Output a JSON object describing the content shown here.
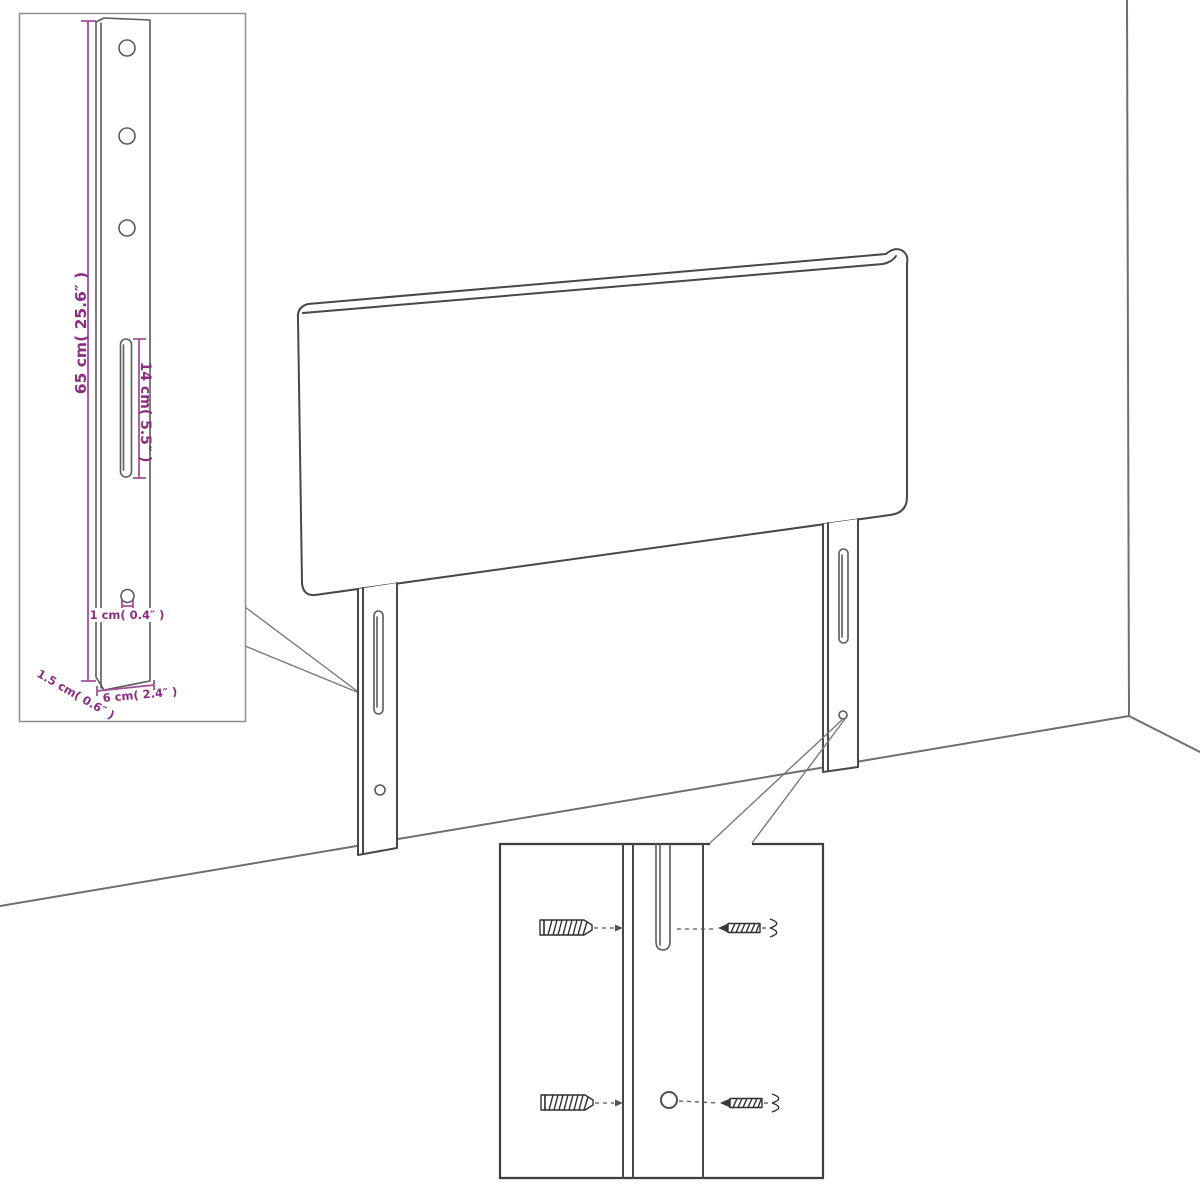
{
  "page": {
    "background": "#ffffff",
    "description": "Black-and-white line-art product diagram of an upholstered headboard with two mounting legs standing in a room corner, with two zoom-in detail insets"
  },
  "colors": {
    "drawing_line": "#474747",
    "wall_line": "#6e6e6e",
    "dimension_line": "#a0509a",
    "dimension_text": "#8b2d80",
    "inset_border_light": "#8f8f8f",
    "inset_border_dark": "#3f3f3f"
  },
  "leg_detail_inset": {
    "dimensions": {
      "leg_height": "65 cm( 25.6″ )",
      "slot_length": "14 cm( 5.5″ )",
      "hole_diameter": "1 cm( 0.4″ )",
      "leg_thickness": "1.5 cm( 0.6″ )",
      "leg_width": "6 cm( 2.4″ )"
    },
    "features": [
      "three-screw-holes",
      "adjustment-slot",
      "small-hole"
    ]
  },
  "mounting_detail_inset": {
    "rows": 2,
    "icons": [
      "wall-anchor-icon",
      "screw-icon"
    ],
    "targets": [
      "leg-slot",
      "leg-hole"
    ]
  },
  "scene": {
    "elements": [
      "headboard",
      "left-mounting-leg",
      "right-mounting-leg",
      "room-corner"
    ]
  }
}
